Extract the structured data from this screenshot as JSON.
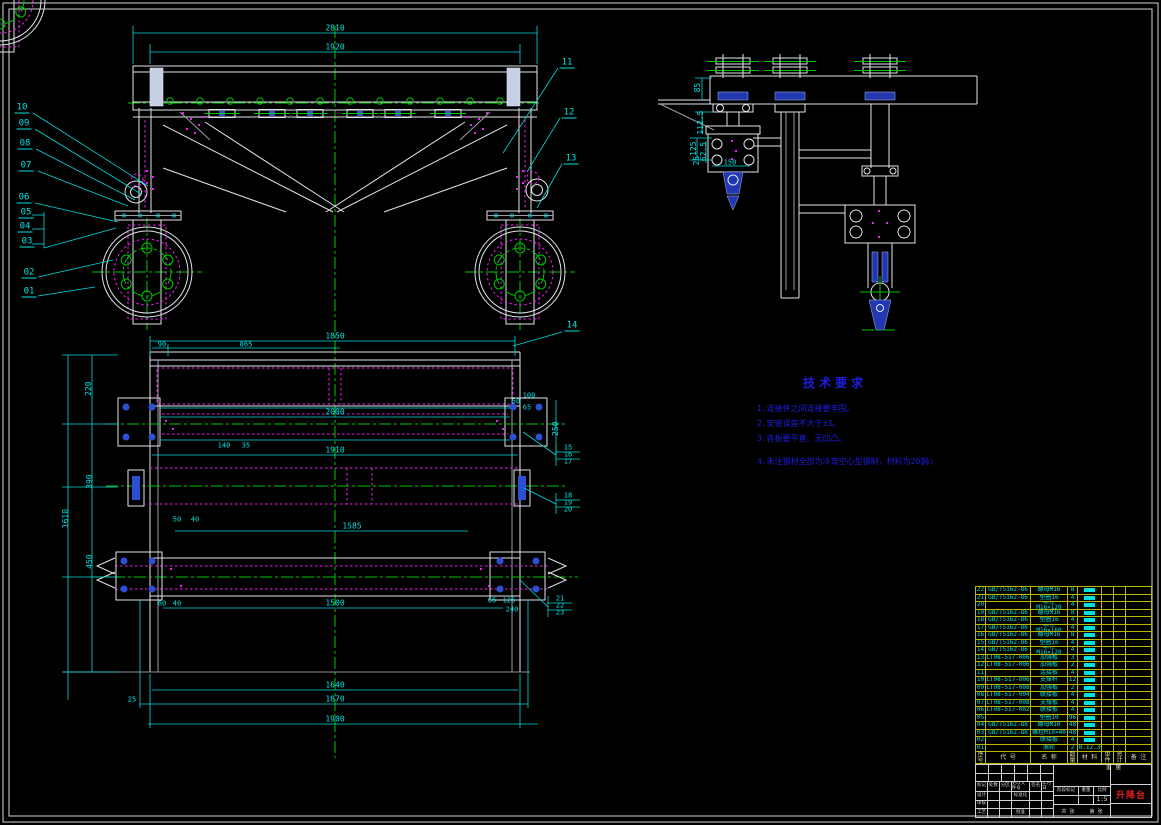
{
  "drawing_title": "升降台",
  "tech": {
    "title": "技术要求",
    "items": [
      "1.连接件之间连接要牢固。",
      "2.安装误差不大于±3。",
      "3.各板要平直、无凹凸。",
      "4.未注钢材全部为冷弯空心型钢制，材料为20钢○"
    ]
  },
  "annotations": {
    "fv_dim_2810": "2810",
    "fv_dim_1920": "1920",
    "co_10": "10",
    "co_09": "09",
    "co_08": "08",
    "co_07": "07",
    "co_06": "06",
    "co_05": "05",
    "co_04": "04",
    "co_03": "03",
    "co_02": "02",
    "co_01": "01",
    "co_11": "11",
    "co_12": "12",
    "co_13": "13",
    "co_14": "14",
    "sv_85": "85",
    "sv_112_5": "112.5",
    "sv_125": "125",
    "sv_62_5": "62.5",
    "sv_25": "25",
    "sv_150": "150",
    "pv_1850": "1850",
    "pv_90": "90",
    "pv_865": "865",
    "pv_220": "220",
    "pv_390": "390",
    "pv_450": "450",
    "pv_1610": "1610",
    "pv_2000": "2000",
    "pv_1910": "1910",
    "pv_1585": "1585",
    "pv_140": "140",
    "pv_35": "35",
    "pv_50": "50",
    "pv_40": "40",
    "pv_60": "60",
    "pv_40b": "40",
    "pv_1500": "1500",
    "pv_1640": "1640",
    "pv_1870": "1870",
    "pv_1900": "1900",
    "pv_25": "25",
    "pv_100": "100",
    "pv_50r": "50",
    "pv_65": "65",
    "pv_250": "250",
    "pv_65r": "65",
    "pv_125r": "125",
    "pv_240": "240",
    "co_15": "15",
    "co_16": "16",
    "co_17": "17",
    "co_18": "18",
    "co_19": "19",
    "co_20": "20",
    "co_21": "21",
    "co_22": "22",
    "co_23": "23"
  },
  "bom": {
    "headers": {
      "no": "序号",
      "code": "代 号",
      "name": "名 称",
      "qty": "数量",
      "material": "材 料",
      "unit": "单件",
      "total": "总计",
      "weight": "重 量",
      "remark": "备 注"
    },
    "rows": [
      {
        "no": "22",
        "code": "GB/T5162-86",
        "name": "螺母M16",
        "qty": "8",
        "material": ""
      },
      {
        "no": "21",
        "code": "GB/T5162-86",
        "name": "垫圈16",
        "qty": "4",
        "material": ""
      },
      {
        "no": "20",
        "code": "",
        "name": "螺栓M16×120",
        "qty": "4",
        "material": ""
      },
      {
        "no": "19",
        "code": "GB/T5162-86",
        "name": "螺母M16",
        "qty": "8",
        "material": ""
      },
      {
        "no": "18",
        "code": "GB/T5162-86",
        "name": "垫圈16",
        "qty": "4",
        "material": ""
      },
      {
        "no": "17",
        "code": "GB/T5162-86",
        "name": "螺栓M16×160",
        "qty": "4",
        "material": ""
      },
      {
        "no": "16",
        "code": "GB/T5162-86",
        "name": "螺母M16",
        "qty": "8",
        "material": ""
      },
      {
        "no": "15",
        "code": "GB/T5162-86",
        "name": "垫圈16",
        "qty": "4",
        "material": ""
      },
      {
        "no": "14",
        "code": "GB/T5162-86",
        "name": "螺栓M16×120",
        "qty": "4",
        "material": ""
      },
      {
        "no": "13",
        "code": "LT08-517-006",
        "name": "加强板",
        "qty": "3",
        "material": ""
      },
      {
        "no": "12",
        "code": "LT08-517-006",
        "name": "加强板",
        "qty": "2",
        "material": ""
      },
      {
        "no": "11",
        "code": "",
        "name": "连接板",
        "qty": "4",
        "material": ""
      },
      {
        "no": "10",
        "code": "LT08-517-006",
        "name": "支撑杆",
        "qty": "12",
        "material": ""
      },
      {
        "no": "09",
        "code": "LT08-517-008",
        "name": "加强板",
        "qty": "2",
        "material": ""
      },
      {
        "no": "08",
        "code": "LT08-517-004",
        "name": "联接板",
        "qty": "4",
        "material": ""
      },
      {
        "no": "07",
        "code": "LT08-517-008",
        "name": "支撑板",
        "qty": "4",
        "material": ""
      },
      {
        "no": "06",
        "code": "LT08-517-002",
        "name": "联接板",
        "qty": "4",
        "material": ""
      },
      {
        "no": "05",
        "code": "",
        "name": "垫圈10",
        "qty": "96",
        "material": ""
      },
      {
        "no": "04",
        "code": "GB/T5162-88",
        "name": "螺母M10",
        "qty": "48",
        "material": ""
      },
      {
        "no": "03",
        "code": "GB/T5162-88",
        "name": "螺栓M10×40",
        "qty": "48",
        "material": ""
      },
      {
        "no": "02",
        "code": "",
        "name": "联接板",
        "qty": "4",
        "material": ""
      },
      {
        "no": "01",
        "code": "",
        "name": "滚轮",
        "qty": "2",
        "material": "20.12.30"
      }
    ]
  },
  "title_block": {
    "product_name": "升降台",
    "scale_value": "1:5",
    "labels": {
      "mark": "标记",
      "count": "处数",
      "zone": "分区",
      "change": "更改文件号",
      "sign": "签名",
      "date": "年月日",
      "design": "设计",
      "check": "审核",
      "process": "工艺",
      "standard": "标准化",
      "approve": "批准",
      "stage": "阶段标记",
      "weight": "重量",
      "scale": "比例",
      "sheet1": "共 张",
      "sheet2": "第 张"
    }
  }
}
